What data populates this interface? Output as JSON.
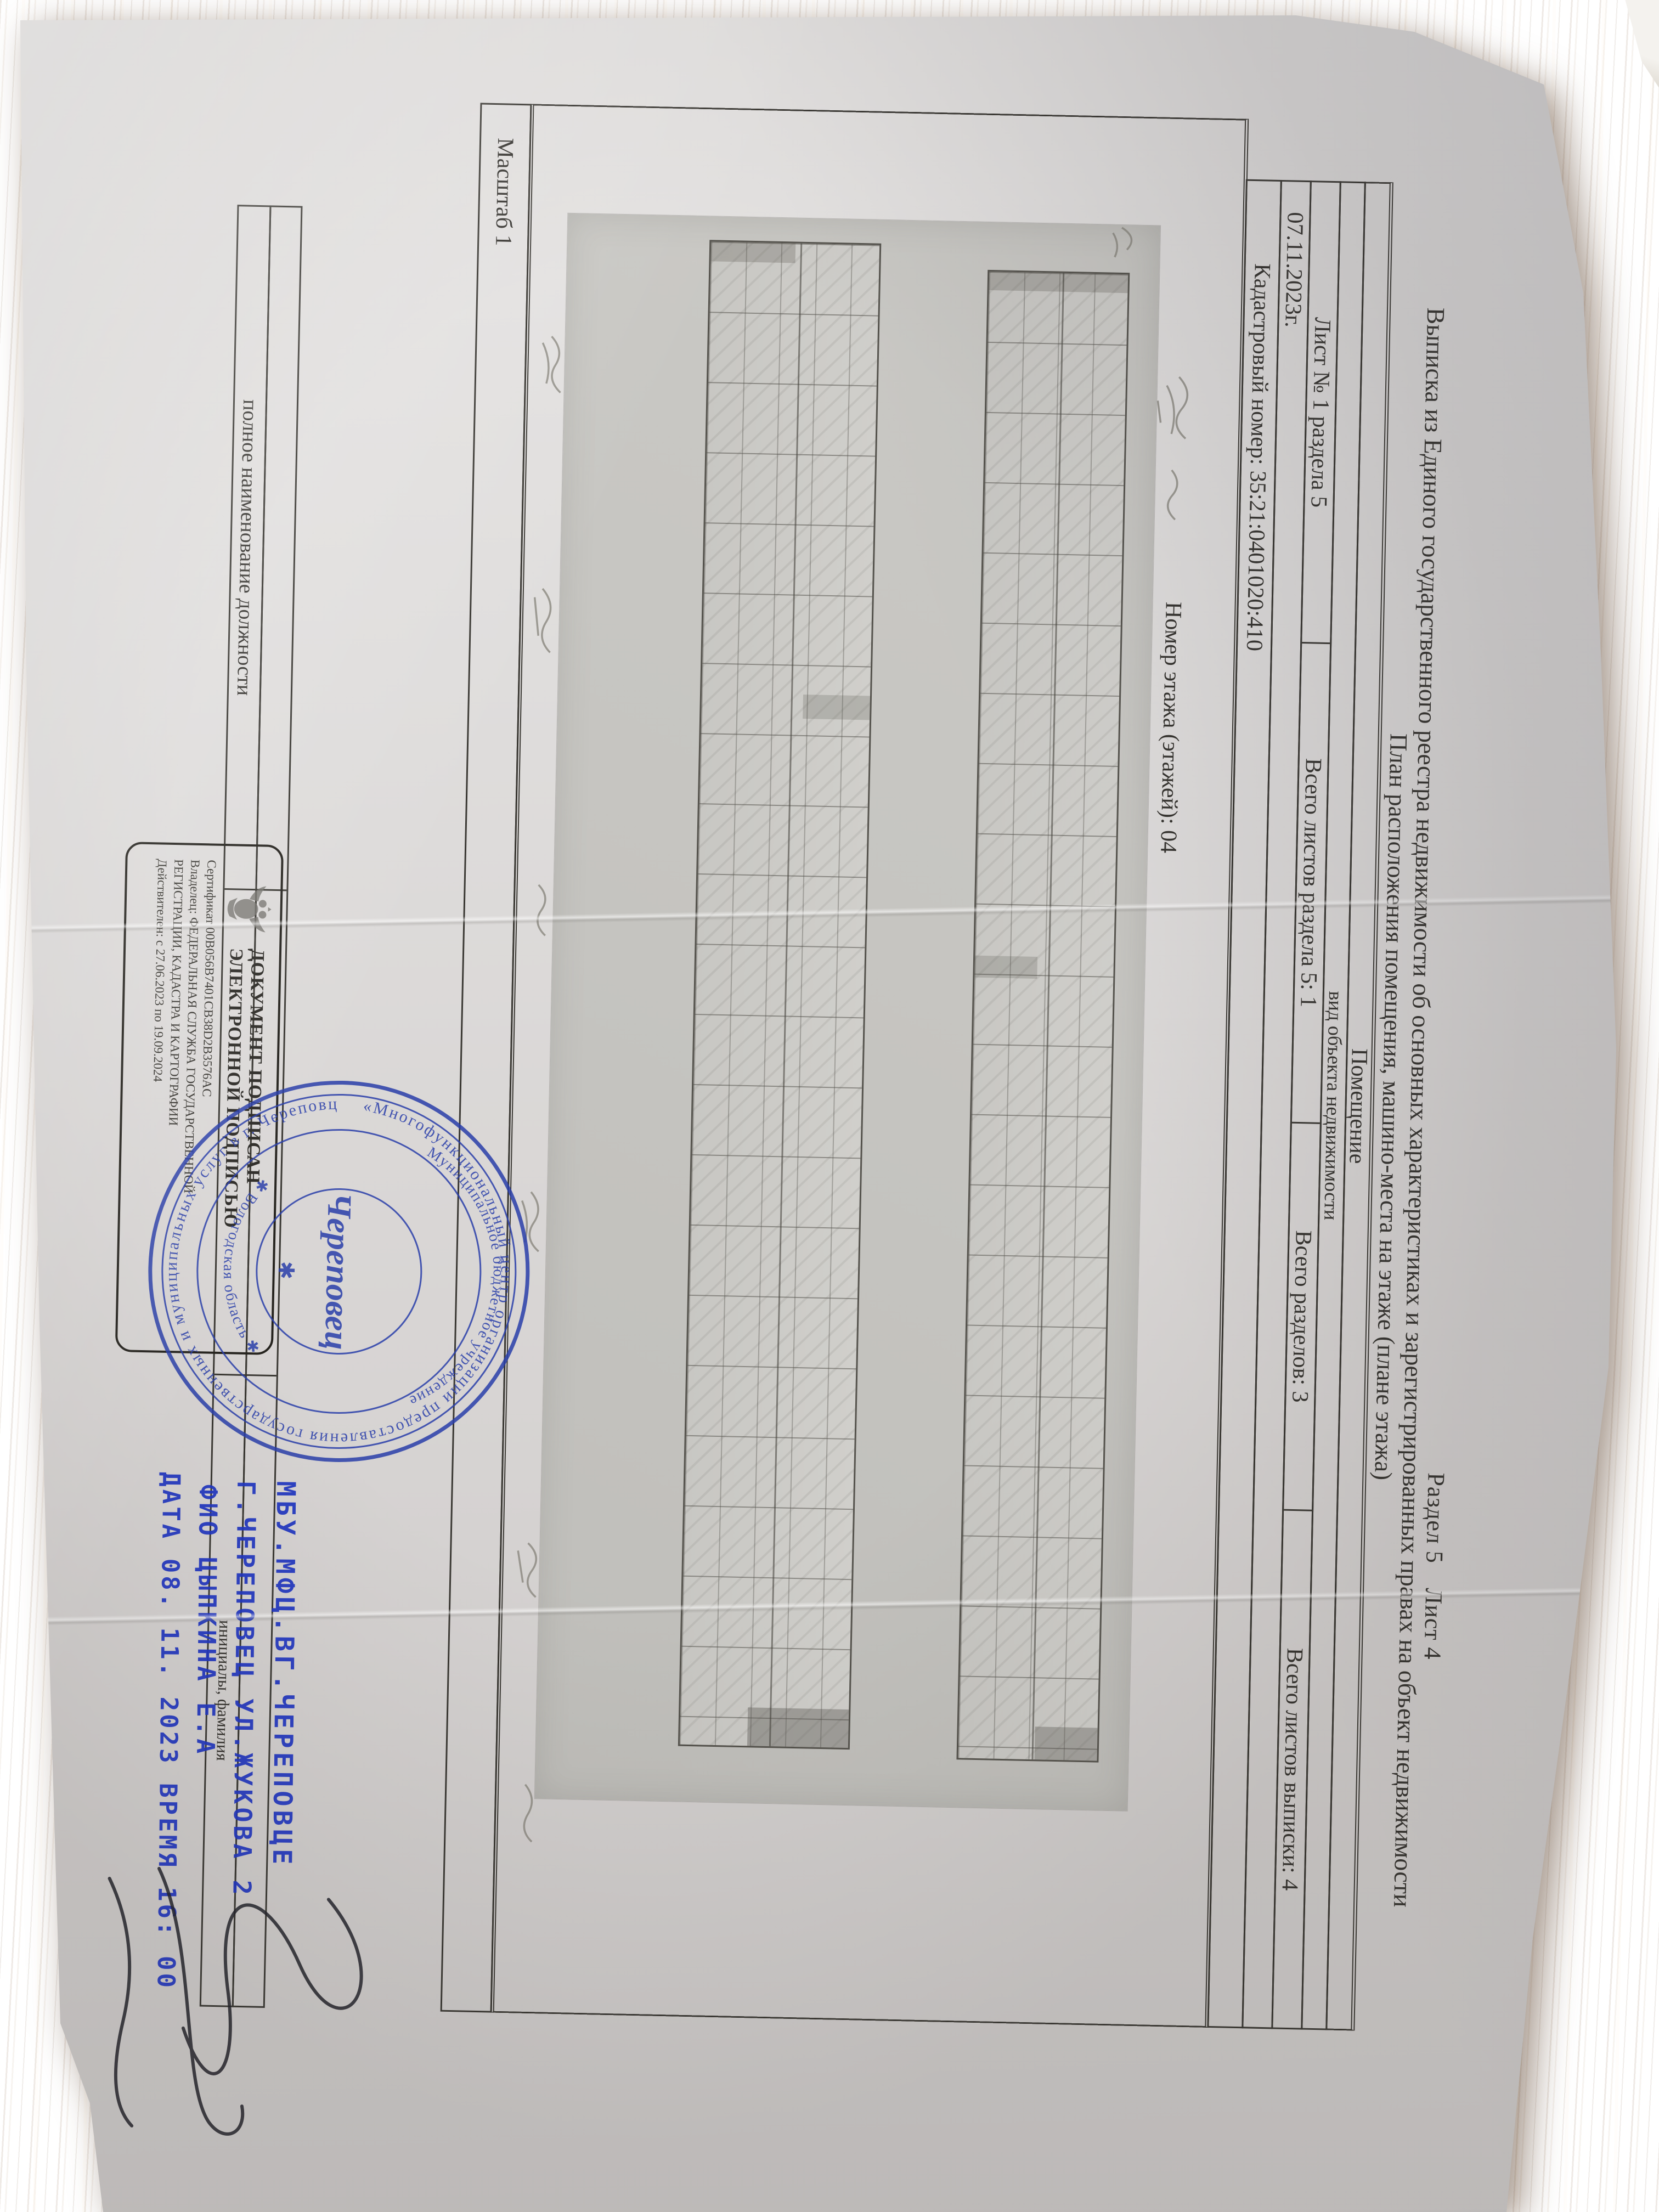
{
  "doc": {
    "razdel": "Раздел 5",
    "list": "Лист 4",
    "title1": "Выписка из Единого государственного реестра недвижимости об основных характеристиках и зарегистрированных правах на объект недвижимости",
    "title2": "План расположения помещения, машино-места на этаже (плане этажа)"
  },
  "table": {
    "object_type": "Помещение",
    "object_caption": "вид объекта недвижимости",
    "sheet_cells": {
      "c1": "Лист № 1 раздела 5",
      "c2": "Всего листов раздела 5: 1",
      "c3": "Всего разделов: 3",
      "c4": "Всего листов выписки: 4"
    },
    "date": "07.11.2023г.",
    "cadastral": "Кадастровый номер: 35:21:0401020:410",
    "floor": "Номер этажа (этажей): 04",
    "scale": "Масштаб 1"
  },
  "sig": {
    "position_label": "полное наименование должности",
    "name_label": "инициалы, фамилия"
  },
  "esig": {
    "t1": "ДОКУМЕНТ ПОДПИСАН",
    "t2": "ЭЛЕКТРОННОЙ ПОДПИСЬЮ",
    "cert": "Сертификат  00B056B7401CB38D2B3576AC",
    "owner1": "Владелец: ФЕДЕРАЛЬНАЯ СЛУЖБА ГОСУДАРСТВЕННОЙ",
    "owner2": "РЕГИСТРАЦИИ, КАДАСТРА И КАРТОГРАФИИ",
    "valid": "Действителен: с 27.06.2023 по 19.09.2024"
  },
  "stamp": {
    "ring_outer_top": "Муниципальное бюджетное учреждение",
    "ring_outer_bottom": "✱  Вологодская область  ✱",
    "ring_inner": "«Многофункциональный центр организации предоставления государственных и муниципальных услуг в г. Череповце»",
    "center": "Череповец"
  },
  "ink": {
    "l1": "МБУ.МФЦ.ВГ.ЧЕРЕПОВЦЕ",
    "l2": "Г.ЧЕРЕПОВЕЦ УЛ.ЖУКОВА 2",
    "l3": "ФИО ЦЫПКИНА Е.А",
    "l4": "ДАТА 08. 11. 2023 ВРЕМЯ 16: 00"
  },
  "colors": {
    "stamp_blue": "#2a3faa",
    "ink_blue": "#2136c0",
    "paper": "#dedcdb",
    "scan_gray": "#c6c5c1",
    "wood": "#c9a67a",
    "ink_black": "#35332f"
  }
}
